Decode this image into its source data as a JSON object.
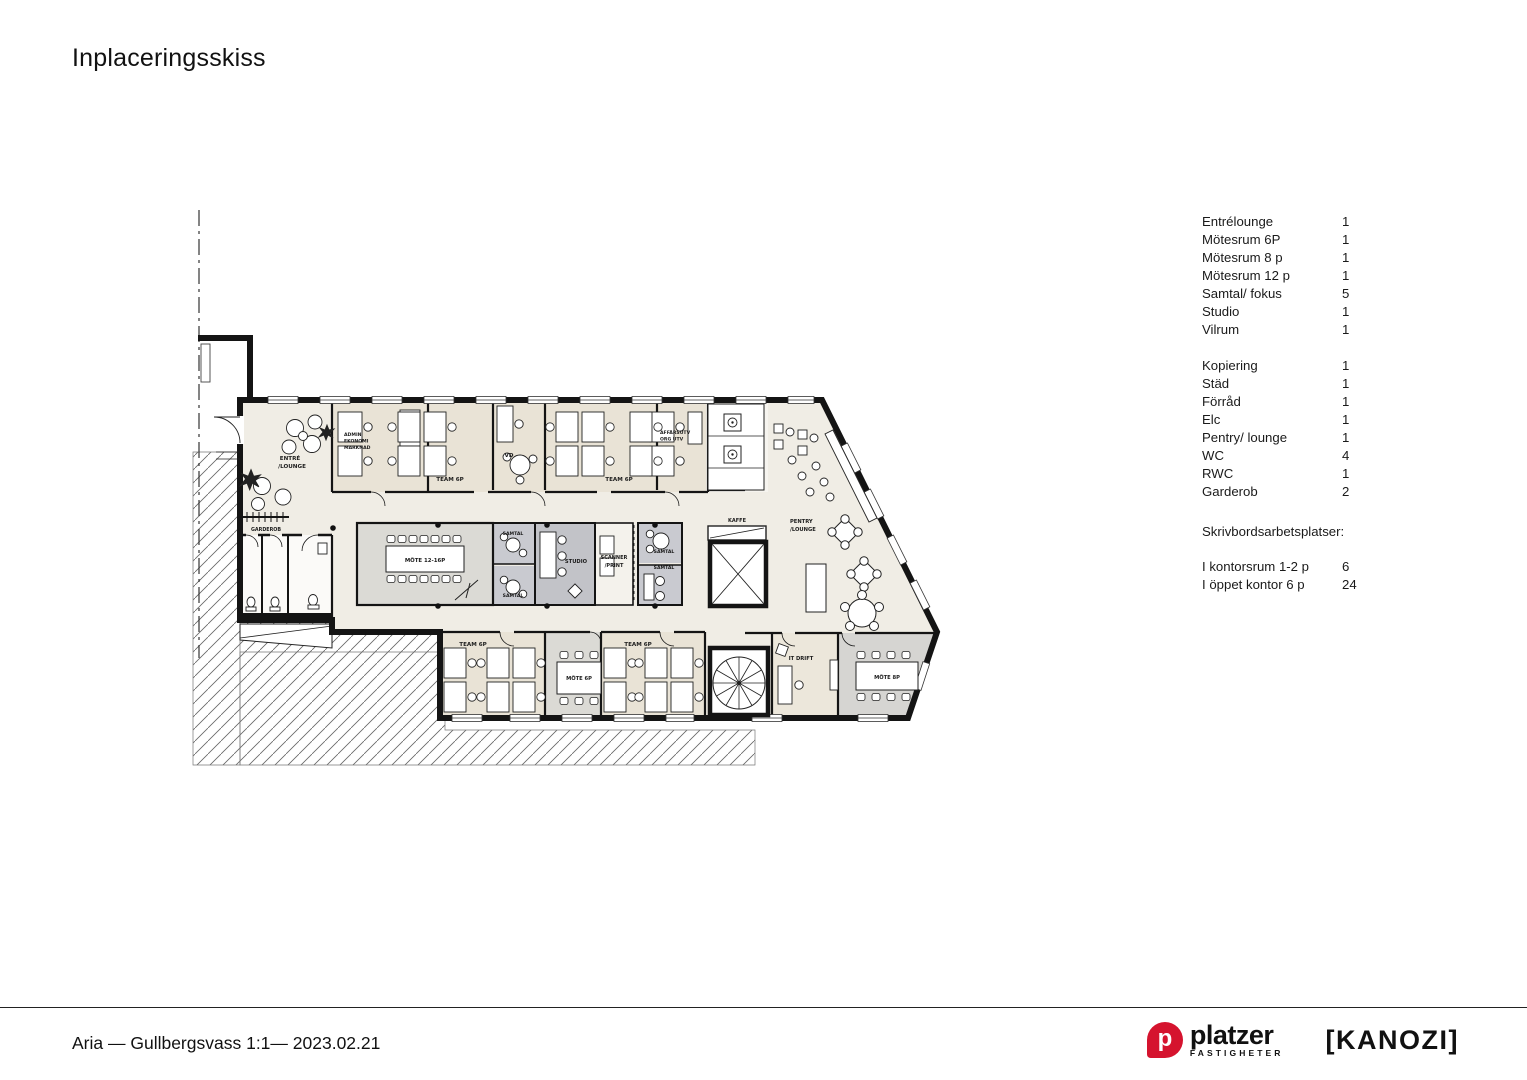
{
  "title": "Inplaceringsskiss",
  "legend": {
    "items": [
      {
        "label": "Entrélounge",
        "count": "1"
      },
      {
        "label": "Mötesrum 6P",
        "count": "1"
      },
      {
        "label": "Mötesrum 8 p",
        "count": "1"
      },
      {
        "label": "Mötesrum 12 p",
        "count": "1"
      },
      {
        "label": "Samtal/ fokus",
        "count": "5"
      },
      {
        "label": "Studio",
        "count": "1"
      },
      {
        "label": "Vilrum",
        "count": "1"
      },
      {
        "label": "Kopiering",
        "count": "1"
      },
      {
        "label": "Städ",
        "count": "1"
      },
      {
        "label": "Förråd",
        "count": "1"
      },
      {
        "label": "Elc",
        "count": "1"
      },
      {
        "label": "Pentry/ lounge",
        "count": "1"
      },
      {
        "label": "WC",
        "count": "4"
      },
      {
        "label": "RWC",
        "count": "1"
      },
      {
        "label": "Garderob",
        "count": "2"
      }
    ],
    "desks_title": "Skrivbordsarbetsplatser:",
    "desk_items": [
      {
        "label": "I kontorsrum 1-2 p",
        "count": "6"
      },
      {
        "label": "I öppet kontor 6 p",
        "count": "24"
      }
    ]
  },
  "plan": {
    "labels": {
      "entre1": "ENTRÉ",
      "entre2": "/LOUNGE",
      "admin1": "ADMIN",
      "admin2": "EKONOMI",
      "admin3": "MARKNAD",
      "team_top_left": "TEAM 6P",
      "vd": "VD",
      "team_top_right": "TEAM 6P",
      "affars1": "AFFÄRSUTV",
      "affars2": "ORG UTV",
      "kaffe": "KAFFE",
      "pentry1": "PENTRY",
      "pentry2": "/LOUNGE",
      "garderob": "GARDEROB",
      "mote12": "MÖTE 12-16P",
      "samtal_tl": "SAMTAL",
      "samtal_bl": "SAMTAL",
      "samtal_tr": "SAMTAL",
      "samtal_br": "SAMTAL",
      "studio": "STUDIO",
      "scanner1": "SCANNER",
      "scanner2": "/PRINT",
      "team_bot_left": "TEAM 6P",
      "mote6": "MÖTE 6P",
      "team_bot_right": "TEAM 6P",
      "itdrift": "IT DRIFT",
      "mote8": "MÖTE 8P"
    }
  },
  "footer": {
    "project": "Aria — Gullbergsvass 1:1— 2023.02.21",
    "platzer_monogram": "p",
    "platzer_name": "platzer",
    "platzer_sub": "FASTIGHETER",
    "kanozi": "[KANOZI]"
  },
  "colors": {
    "wall": "#141414",
    "floor": "#f0ede5",
    "room_beige": "#e9e3d6",
    "room_gray": "#dbdad5",
    "room_gray_dark": "#c2c3c8",
    "samtal_gray": "#c9cad0",
    "accent_red": "#d5132e"
  }
}
